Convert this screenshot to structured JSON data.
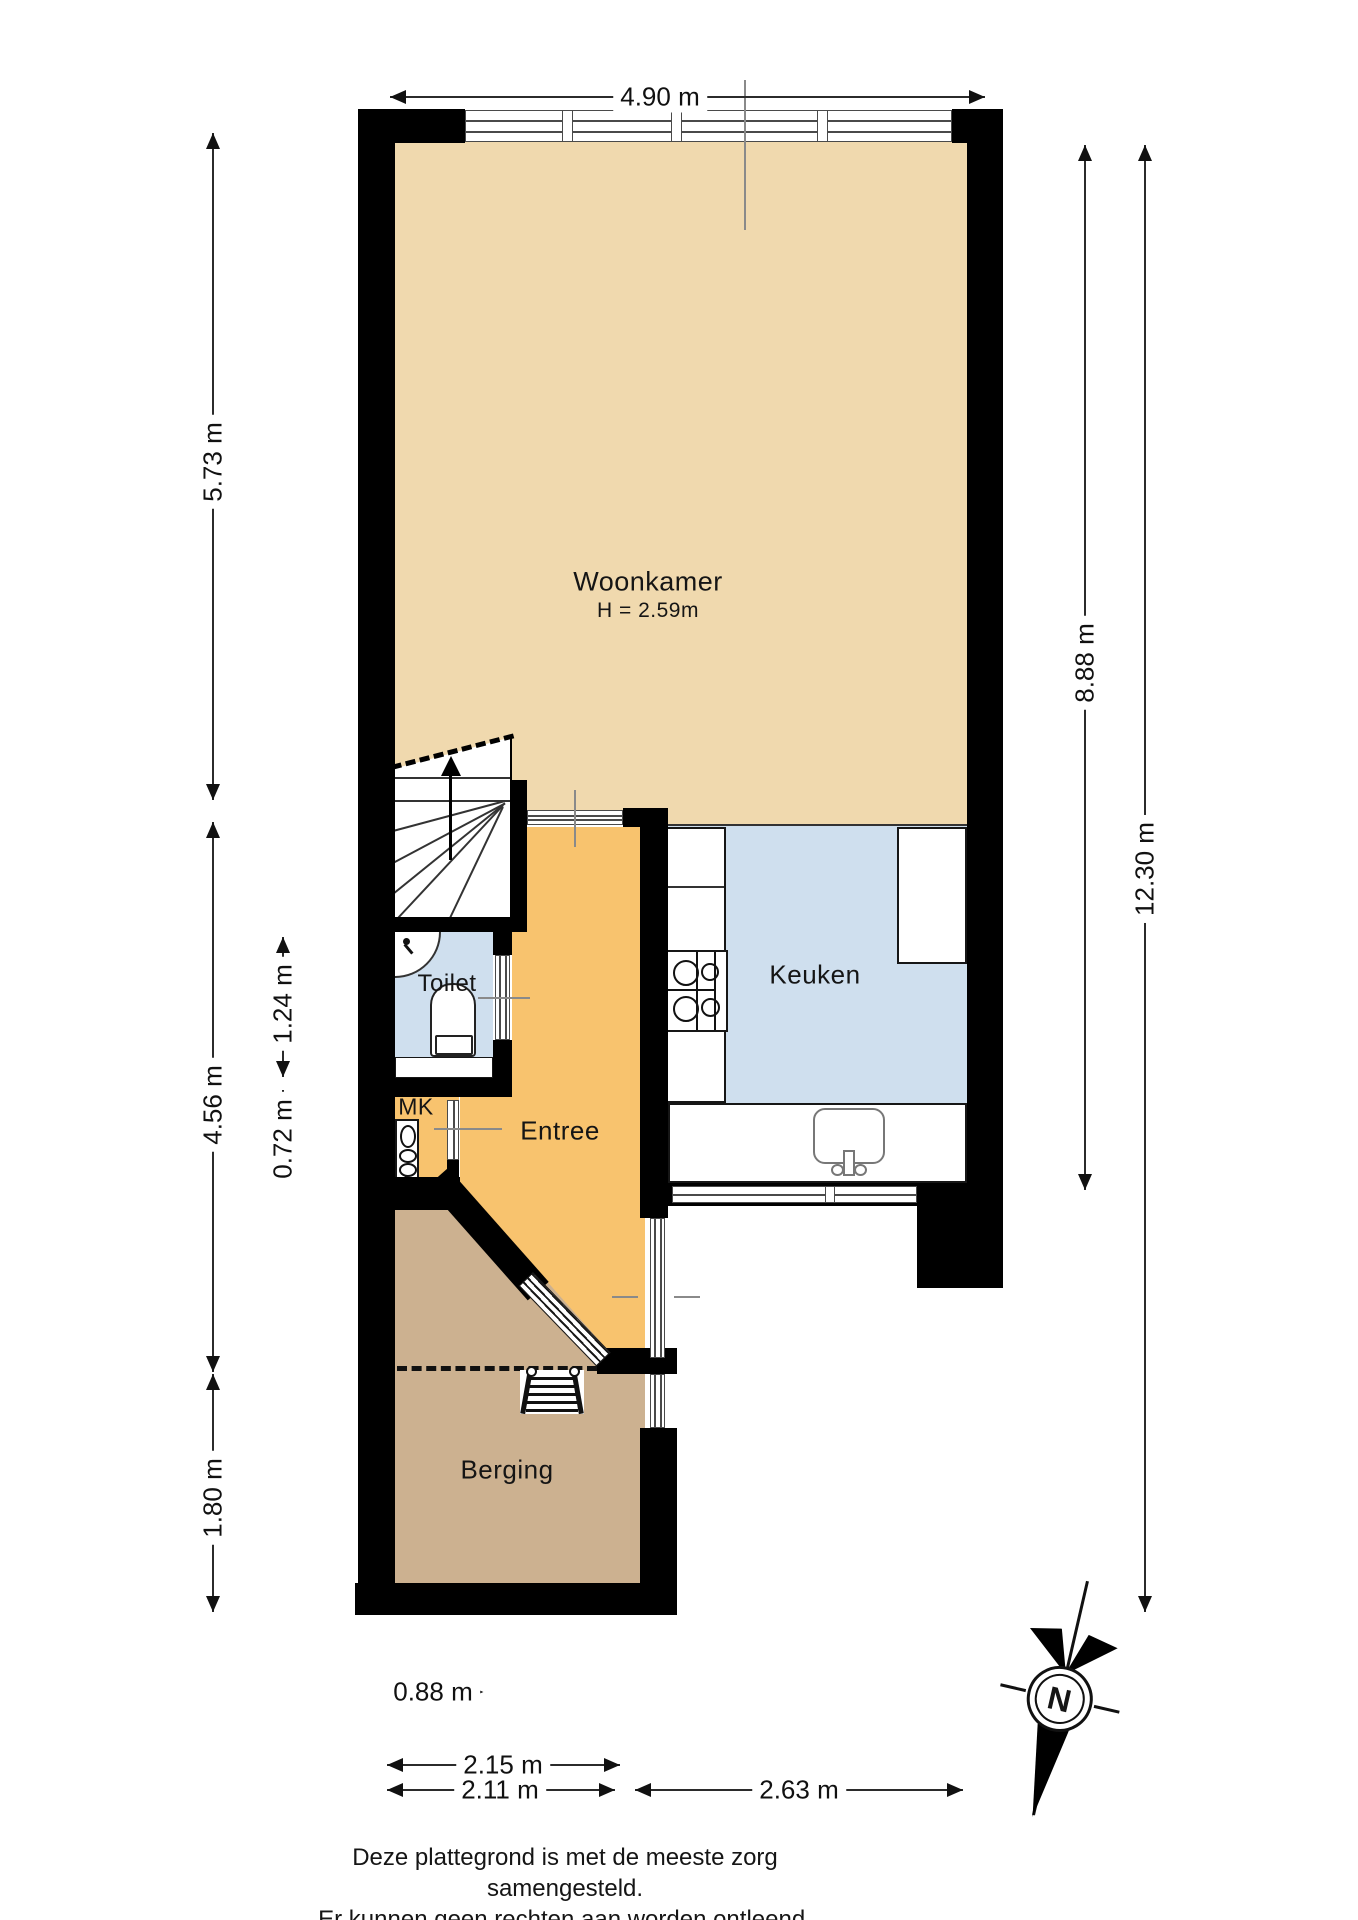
{
  "rooms": {
    "woonkamer": {
      "label": "Woonkamer",
      "height_note": "H = 2.59m"
    },
    "keuken": {
      "label": "Keuken"
    },
    "toilet": {
      "label": "Toilet"
    },
    "entree": {
      "label": "Entree"
    },
    "meterkast": {
      "label": "MK"
    },
    "berging": {
      "label": "Berging"
    }
  },
  "dimensions": {
    "top_width": "4.90 m",
    "living_depth": "5.73 m",
    "hall_depth": "4.56 m",
    "toilet_depth": "1.24 m",
    "meterkast_depth": "0.72 m",
    "berging_depth": "1.80 m",
    "inner_depth": "8.88 m",
    "total_depth": "12.30 m",
    "front_door_width": "0.88 m",
    "berging_outer_width": "2.15 m",
    "berging_inner_width": "2.11 m",
    "keuken_width": "2.63 m"
  },
  "compass": {
    "north_label": "N"
  },
  "footer": {
    "line1": "Deze plattegrond is met de meeste zorg samengesteld.",
    "line2": "Er kunnen geen rechten aan worden ontleend."
  },
  "icons": [
    "compass-icon",
    "stove-icon",
    "kitchen-sink-icon",
    "toilet-bowl-icon",
    "hand-basin-icon",
    "meter-cabinet-icon",
    "loft-ladder-icon",
    "staircase-icon",
    "window-symbol",
    "door-symbol"
  ],
  "colors": {
    "living": "#f0d9ae",
    "hall": "#f8c36e",
    "wet": "#cfdfee",
    "storage": "#ccb190",
    "wall": "#000000"
  }
}
